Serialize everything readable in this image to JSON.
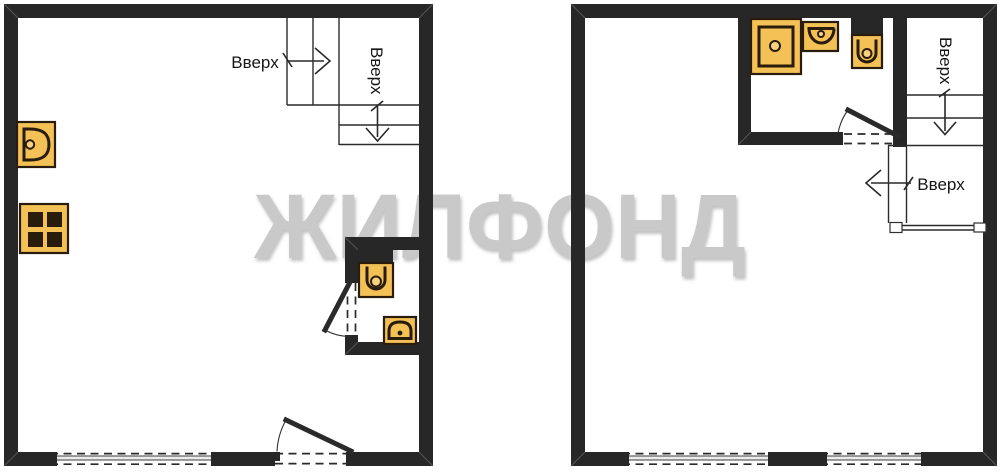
{
  "watermark": {
    "text": "ЖИЛФОНД"
  },
  "colors": {
    "wall": "#272727",
    "line": "#2a2a2a",
    "floor": "#ffffff",
    "glass": "#ececec",
    "fixture": "#f3c155",
    "fixture-light": "#f8d37f",
    "fixture-stroke": "#2a1c0c",
    "watermark": "#c9c9c9",
    "label": "#161616"
  },
  "level1": {
    "stairs": {
      "label_horizontal": "Вверх",
      "label_vertical": "Вверх"
    },
    "fixtures": [
      "kitchen-sink-icon",
      "stove-icon",
      "toilet-icon",
      "washbasin-icon"
    ]
  },
  "level2": {
    "stairs": {
      "label_vertical": "Вверх",
      "label_horizontal": "Вверх"
    },
    "fixtures": [
      "shower-icon",
      "washbasin-icon",
      "toilet-icon"
    ]
  }
}
